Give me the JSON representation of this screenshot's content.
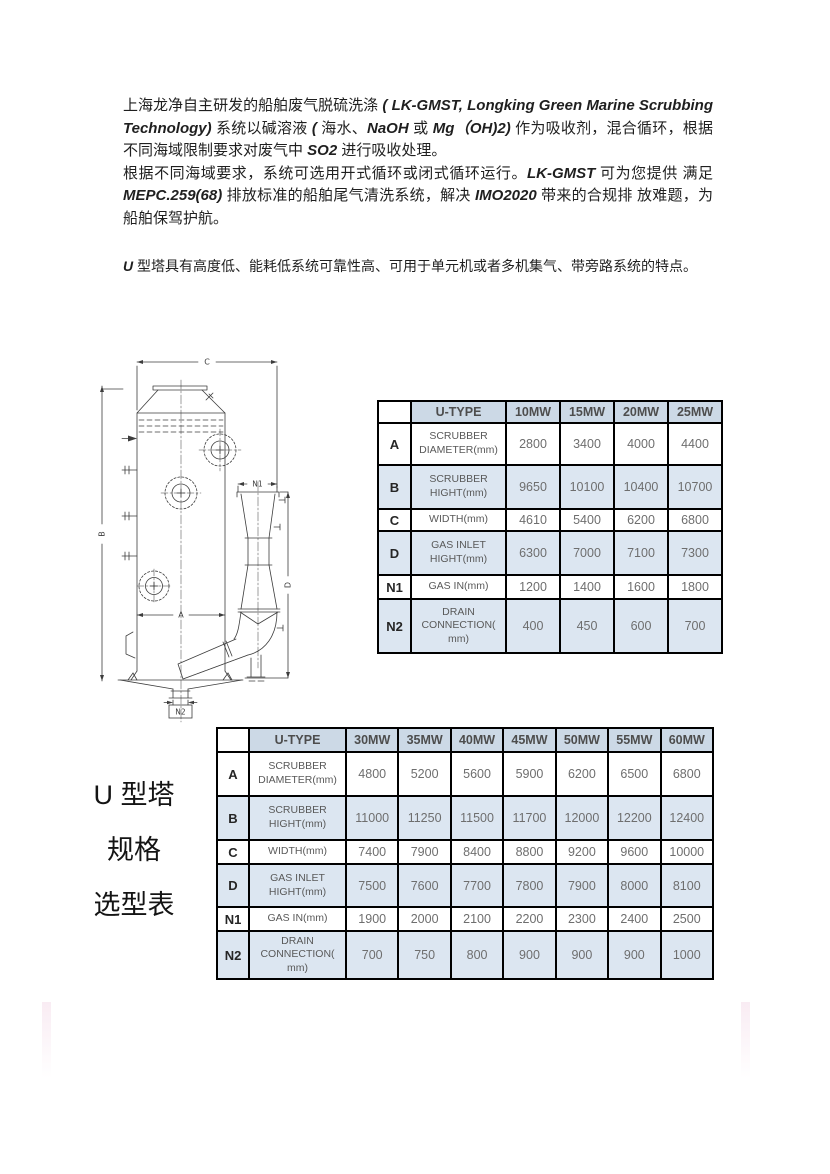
{
  "document": {
    "intro_paragraphs": [
      {
        "segments": [
          {
            "text": "上海龙净自主研发的船舶废气脱硫洗涤 ",
            "style": "cn"
          },
          {
            "text": "( LK-GMST, Longking Green Marine Scrubbing Technology)",
            "style": "latin"
          },
          {
            "text": " 系统以碱溶液 ",
            "style": "cn"
          },
          {
            "text": "(",
            "style": "latin"
          },
          {
            "text": " 海水、",
            "style": "cn"
          },
          {
            "text": "NaOH",
            "style": "latin"
          },
          {
            "text": " 或 ",
            "style": "cn"
          },
          {
            "text": "Mg（OH)2)",
            "style": "latin"
          },
          {
            "text": " 作为吸收剂，混合循环，根据不同海域限制要求对废气中 ",
            "style": "cn"
          },
          {
            "text": "SO2",
            "style": "latin"
          },
          {
            "text": " 进行吸收处理。",
            "style": "cn"
          }
        ]
      },
      {
        "segments": [
          {
            "text": "根据不同海域要求，系统可选用开式循环或闭式循环运行。",
            "style": "cn"
          },
          {
            "text": "LK-GMST",
            "style": "latin"
          },
          {
            "text": " 可为您提供 满足 ",
            "style": "cn"
          },
          {
            "text": "MEPC.259(68)",
            "style": "latin"
          },
          {
            "text": " 排放标准的船舶尾气清洗系统，解决 ",
            "style": "cn"
          },
          {
            "text": "IMO2020",
            "style": "latin"
          },
          {
            "text": " 带来的合规排 放难题，为船舶保驾护航。",
            "style": "cn"
          }
        ]
      }
    ],
    "feature_paragraph": {
      "segments": [
        {
          "text": "U",
          "style": "latin"
        },
        {
          "text": " 型塔具有高度低、能耗低系统可靠性高、可用于单元机或者多机集气、带旁路系统的特点。",
          "style": "cn"
        }
      ]
    },
    "side_caption": {
      "lines": [
        "U 型塔",
        "规格",
        "选型表"
      ]
    },
    "diagram": {
      "labels": {
        "c": "C",
        "b": "B",
        "a": "A",
        "d": "D",
        "n1": "N1",
        "n2": "N2"
      }
    },
    "tables": [
      {
        "header": [
          "",
          "U-TYPE",
          "10MW",
          "15MW",
          "20MW",
          "25MW"
        ],
        "rows": [
          {
            "key": "A",
            "param": "SCRUBBER DIAMETER(mm)",
            "values": [
              "2800",
              "3400",
              "4000",
              "4400"
            ],
            "shaded": false
          },
          {
            "key": "B",
            "param": "SCRUBBER HIGHT(mm)",
            "values": [
              "9650",
              "10100",
              "10400",
              "10700"
            ],
            "shaded": true
          },
          {
            "key": "C",
            "param": "WIDTH(mm)",
            "values": [
              "4610",
              "5400",
              "6200",
              "6800"
            ],
            "shaded": false
          },
          {
            "key": "D",
            "param": "GAS INLET HIGHT(mm)",
            "values": [
              "6300",
              "7000",
              "7100",
              "7300"
            ],
            "shaded": true
          },
          {
            "key": "N1",
            "param": "GAS IN(mm)",
            "values": [
              "1200",
              "1400",
              "1600",
              "1800"
            ],
            "shaded": false
          },
          {
            "key": "N2",
            "param": "DRAIN CONNECTION( mm)",
            "values": [
              "400",
              "450",
              "600",
              "700"
            ],
            "shaded": true
          }
        ]
      },
      {
        "header": [
          "",
          "U-TYPE",
          "30MW",
          "35MW",
          "40MW",
          "45MW",
          "50MW",
          "55MW",
          "60MW"
        ],
        "rows": [
          {
            "key": "A",
            "param": "SCRUBBER DIAMETER(mm)",
            "values": [
              "4800",
              "5200",
              "5600",
              "5900",
              "6200",
              "6500",
              "6800"
            ],
            "shaded": false
          },
          {
            "key": "B",
            "param": "SCRUBBER HIGHT(mm)",
            "values": [
              "11000",
              "11250",
              "11500",
              "11700",
              "12000",
              "12200",
              "12400"
            ],
            "shaded": true
          },
          {
            "key": "C",
            "param": "WIDTH(mm)",
            "values": [
              "7400",
              "7900",
              "8400",
              "8800",
              "9200",
              "9600",
              "10000"
            ],
            "shaded": false
          },
          {
            "key": "D",
            "param": "GAS INLET HIGHT(mm)",
            "values": [
              "7500",
              "7600",
              "7700",
              "7800",
              "7900",
              "8000",
              "8100"
            ],
            "shaded": true
          },
          {
            "key": "N1",
            "param": "GAS IN(mm)",
            "values": [
              "1900",
              "2000",
              "2100",
              "2200",
              "2300",
              "2400",
              "2500"
            ],
            "shaded": false
          },
          {
            "key": "N2",
            "param": "DRAIN CONNECTION( mm)",
            "values": [
              "700",
              "750",
              "800",
              "900",
              "900",
              "900",
              "1000"
            ],
            "shaded": true
          }
        ]
      }
    ],
    "colors": {
      "table_header_bg": "#ccd9e6",
      "table_shaded_row_bg": "#dce6f1",
      "table_border": "#000000",
      "table_text": "#595959",
      "drawing_stroke": "#3d3d3d"
    }
  }
}
